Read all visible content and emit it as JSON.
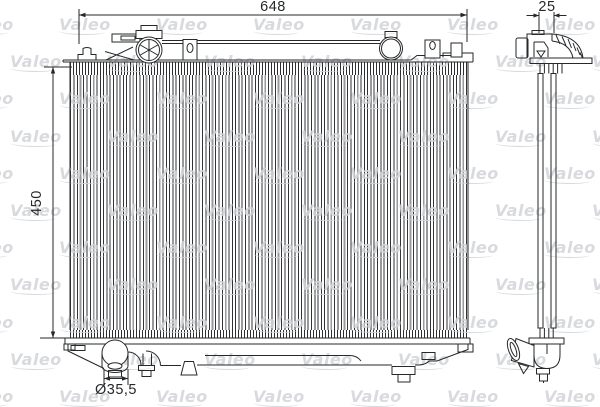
{
  "colors": {
    "line": "#26282a",
    "background": "#ffffff"
  },
  "watermark": {
    "text": "Valeo",
    "color": "#d2d4d8"
  },
  "dimensions": {
    "top_width": "648",
    "left_height": "450",
    "side_depth": "25",
    "outlet_diameter": "Ø35,5"
  }
}
